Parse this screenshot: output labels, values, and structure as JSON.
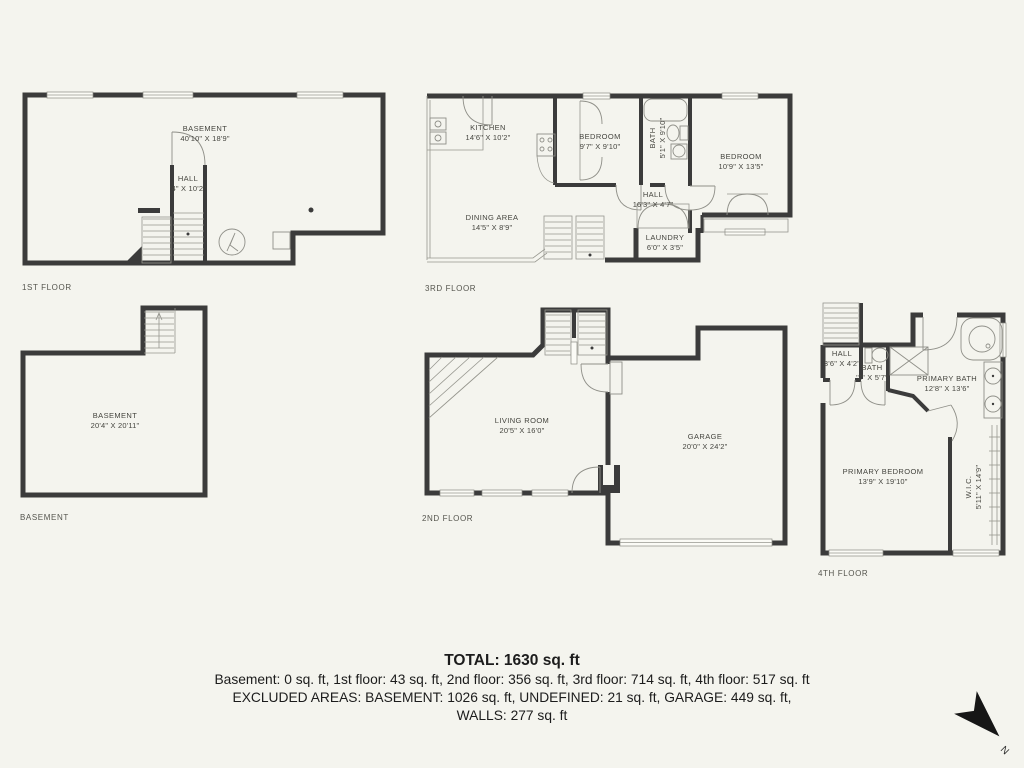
{
  "colors": {
    "background": "#f4f4ee",
    "wall": "#3b3b3b",
    "thin_line": "#8f8f88",
    "label_text": "#45453f",
    "summary_text": "#1c1c1c"
  },
  "floors": [
    {
      "caption": "1ST FLOOR",
      "rooms": [
        {
          "name": "BASEMENT",
          "dims": "40'10\" X 18'9\""
        },
        {
          "name": "HALL",
          "dims": "'4\" X 10'2\""
        }
      ]
    },
    {
      "caption": "3RD FLOOR",
      "rooms": [
        {
          "name": "KITCHEN",
          "dims": "14'6\" X 10'2\""
        },
        {
          "name": "BEDROOM",
          "dims": "9'7\" X 9'10\""
        },
        {
          "name": "BATH",
          "dims": "5'1\" X 9'10\""
        },
        {
          "name": "BEDROOM",
          "dims": "10'9\" X 13'5\""
        },
        {
          "name": "HALL",
          "dims": "16'3\" X 4'7\""
        },
        {
          "name": "DINING AREA",
          "dims": "14'5\" X 8'9\""
        },
        {
          "name": "LAUNDRY",
          "dims": "6'0\" X 3'5\""
        }
      ]
    },
    {
      "caption": "BASEMENT",
      "rooms": [
        {
          "name": "BASEMENT",
          "dims": "20'4\" X 20'11\""
        }
      ]
    },
    {
      "caption": "2ND FLOOR",
      "rooms": [
        {
          "name": "LIVING ROOM",
          "dims": "20'5\" X 16'0\""
        },
        {
          "name": "GARAGE",
          "dims": "20'0\" X 24'2\""
        }
      ]
    },
    {
      "caption": "4TH FLOOR",
      "rooms": [
        {
          "name": "HALL",
          "dims": "3'6\" X 4'2\""
        },
        {
          "name": "BATH",
          "dims": "'2\" X 5'7\""
        },
        {
          "name": "PRIMARY BATH",
          "dims": "12'8\" X 13'6\""
        },
        {
          "name": "PRIMARY BEDROOM",
          "dims": "13'9\" X 19'10\""
        },
        {
          "name": "W.I.C.",
          "dims": "5'11\" X 14'9\""
        }
      ]
    }
  ],
  "summary": {
    "total": "TOTAL: 1630 sq. ft",
    "floors_line": "Basement: 0 sq. ft, 1st floor: 43 sq. ft, 2nd floor: 356 sq. ft, 3rd floor: 714 sq. ft, 4th floor: 517 sq. ft",
    "excluded_line": "EXCLUDED AREAS: BASEMENT: 1026 sq. ft, UNDEFINED: 21 sq. ft, GARAGE: 449 sq. ft,",
    "walls_line": "WALLS: 277 sq. ft"
  },
  "compass": {
    "label": "N"
  }
}
